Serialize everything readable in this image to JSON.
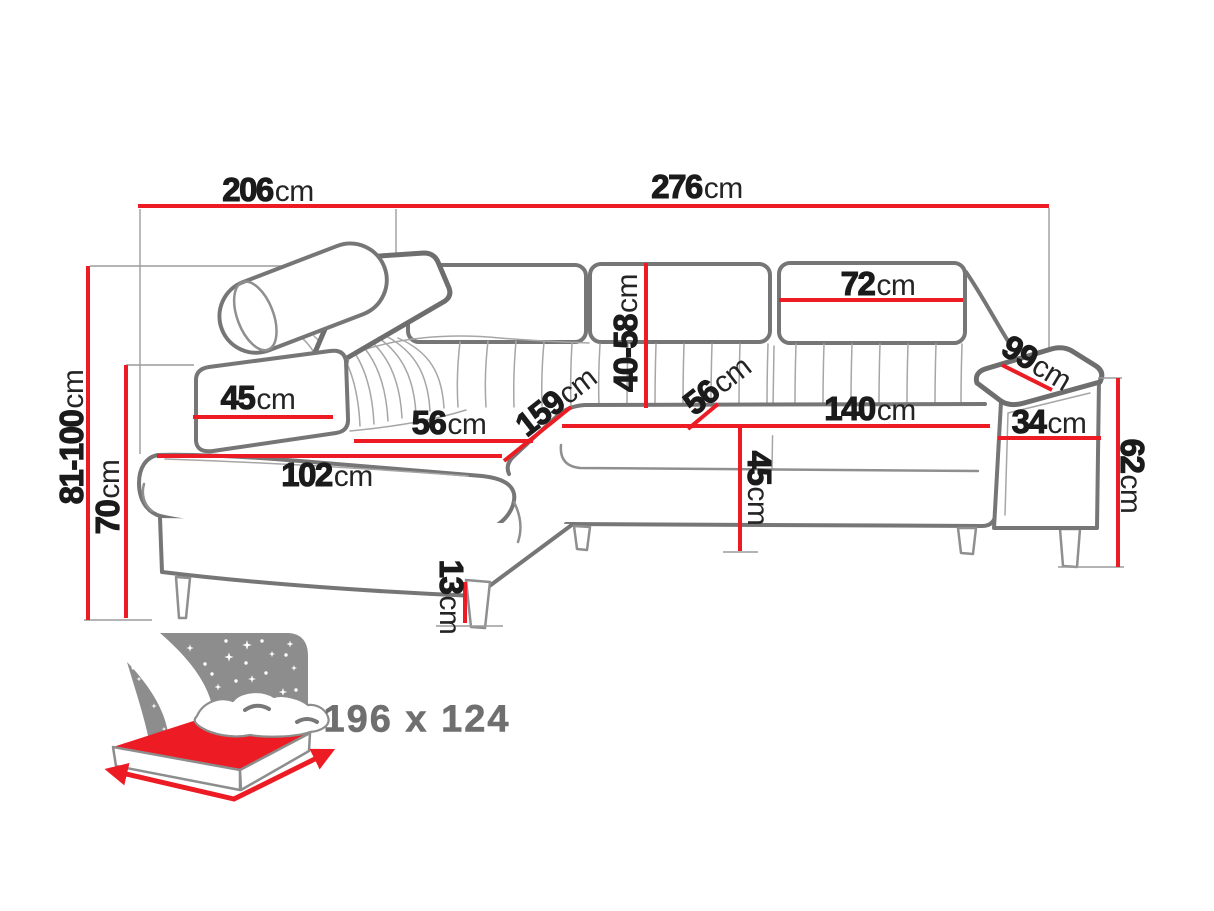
{
  "diagram": {
    "kind": "furniture dimension drawing",
    "subject": "corner sofa with adjustable headrest and sleeping function"
  },
  "colors": {
    "dimension_line_red": "#ed1c24",
    "sofa_outline_gray": "#767676",
    "icon_gray": "#8d8d8d",
    "label_text": "#1b1b1b",
    "background": "#ffffff"
  },
  "dims": {
    "overall_depth_left": {
      "value": "206",
      "unit": "cm"
    },
    "overall_width": {
      "value": "276",
      "unit": "cm"
    },
    "back_cushion_width": {
      "value": "72",
      "unit": "cm"
    },
    "backrest_height": {
      "value": "40-58",
      "unit": "cm"
    },
    "armrest_depth": {
      "value": "99",
      "unit": "cm"
    },
    "armrest_width": {
      "value": "34",
      "unit": "cm"
    },
    "armrest_height": {
      "value": "62",
      "unit": "cm"
    },
    "seat_width": {
      "value": "140",
      "unit": "cm"
    },
    "seat_depth": {
      "value": "56",
      "unit": "cm"
    },
    "chaise_length": {
      "value": "159",
      "unit": "cm"
    },
    "chaise_seat_width": {
      "value": "56",
      "unit": "cm"
    },
    "side_cushion_depth": {
      "value": "45",
      "unit": "cm"
    },
    "chaise_front_width": {
      "value": "102",
      "unit": "cm"
    },
    "overall_height_range": {
      "value": "81-100",
      "unit": "cm"
    },
    "armrest_front_height": {
      "value": "70",
      "unit": "cm"
    },
    "seat_height": {
      "value": "45",
      "unit": "cm"
    },
    "leg_height": {
      "value": "13",
      "unit": "cm"
    }
  },
  "sleeping_area": {
    "label": "196 x 124"
  }
}
